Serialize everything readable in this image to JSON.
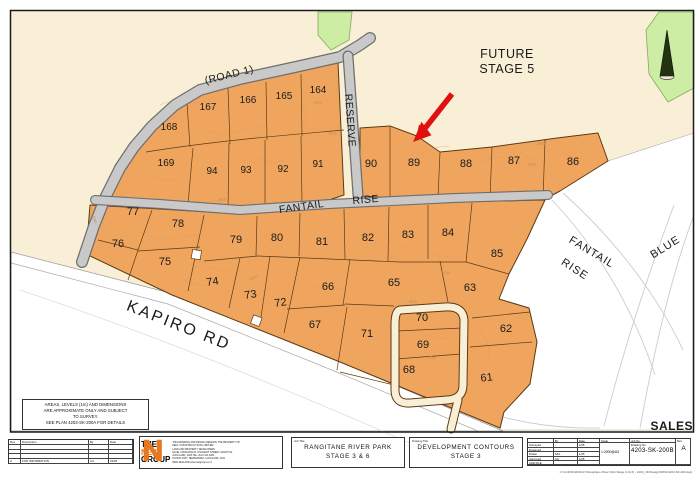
{
  "map": {
    "future_stage": [
      "FUTURE",
      "STAGE 5"
    ],
    "sales": "SALES",
    "roads": {
      "road1": "(ROAD 1)",
      "reserve": "RESERVE",
      "fantail": "FANTAIL",
      "rise": "RISE",
      "kapiro": "KAPIRO RD",
      "future_fantail": "FANTAIL",
      "future_rise": "RISE",
      "blue": "BLUE"
    },
    "lots": [
      "164",
      "165",
      "166",
      "167",
      "168",
      "169",
      "94",
      "93",
      "92",
      "91",
      "90",
      "89",
      "88",
      "87",
      "86",
      "77",
      "78",
      "76",
      "75",
      "79",
      "80",
      "81",
      "82",
      "83",
      "84",
      "85",
      "74",
      "73",
      "72",
      "66",
      "65",
      "63",
      "67",
      "71",
      "70",
      "69",
      "68",
      "62",
      "61"
    ],
    "dims": [
      "45m",
      "50m",
      "45m",
      "50m",
      "45m",
      "50m",
      "45m",
      "40m",
      "40m",
      "40m"
    ],
    "disclaimer_lines": [
      "AREAS, LEVELS (1m) AND DIMENSIONS",
      "ARE APPROXIMATE ONLY AND SUBJECT",
      "TO SURVEY.",
      "SEE PLAN 4203-SK-200A FOR DETAILS"
    ],
    "colors": {
      "lot_fill": "#f0a55f",
      "plan_bg": "#f9efd6",
      "reserve_green": "#cdeca4",
      "road_grey": "#c9c9c9",
      "arrow_red": "#e01010",
      "sales_red": "#c42a1e"
    }
  },
  "titleblock": {
    "rev_table": {
      "headers": [
        "Rev",
        "Description",
        "By",
        "Date"
      ],
      "row": {
        "rev": "A",
        "description": "FOR INFORMATION",
        "by": "CA",
        "date": "01/25"
      }
    },
    "logo": {
      "the": "THE",
      "neil": "NEIL",
      "group": "GROUP",
      "notice": "THIS DRAWING AND DESIGN REMAINS THE PROPERTY OF",
      "company": "NEIL CONSTRUCTION LIMITED",
      "tagline": "LAND AND PROPERTY DEVELOPERS",
      "addr1": "LEVEL 2 BUILDING B, 8 NUGENT STREET, GRAFTON,",
      "addr2": "AUCKLAND, 1023    TEL +64 9 414 4081",
      "addr3": "PO BOX 9327, NEWMARKET, AUCKLAND, 1149",
      "addr4": "NEW ZEALAND      www.neilgroup.co.nz"
    },
    "job_title_label": "Job Title",
    "job_title_1": "RANGITANE RIVER PARK",
    "job_title_2": "STAGE 3 & 6",
    "drawing_title_label": "Drawing Title",
    "drawing_title_1": "DEVELOPMENT CONTOURS",
    "drawing_title_2": "STAGE 3",
    "sign_table": {
      "col_by": "By",
      "col_date": "Date",
      "col_scale": "Scale",
      "col_job": "Job No.",
      "rows": [
        {
          "label": "Surveyed",
          "by": "-",
          "date": "1/25"
        },
        {
          "label": "Designed",
          "by": "",
          "date": ""
        },
        {
          "label": "Drawn",
          "by": "NKL",
          "date": "1/25"
        },
        {
          "label": "Approved",
          "by": "CA",
          "date": "1/25"
        },
        {
          "label": "CAD FILE",
          "by": "",
          "date": ""
        }
      ],
      "scale": "1:2000@A3",
      "drawing_no_label": "Drawing No.",
      "drawing_no": "4203-SK-200B",
      "rev_label": "Rev",
      "rev": "A"
    },
    "file_path": "C:\\Civil3D\\4203GLY\\Rangitane River Park Stage 3 (& 6) - 4203_4K\\Design\\DWG\\4203-SK-200.dwg"
  }
}
